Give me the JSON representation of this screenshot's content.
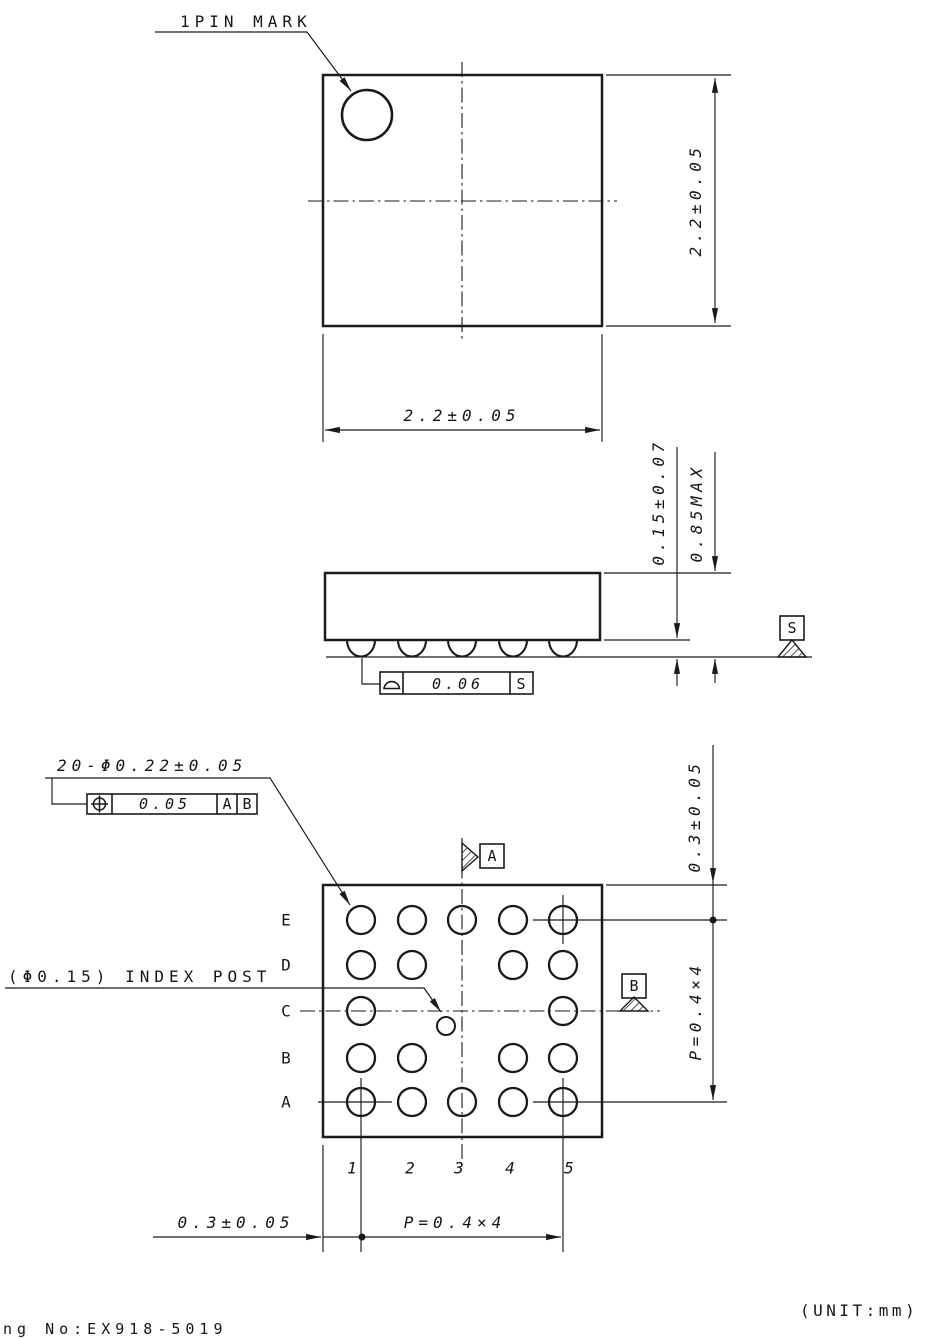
{
  "labels": {
    "pin_mark": "1PIN MARK",
    "index_post": "(Φ0.15) INDEX POST",
    "ball_callout": "20-Φ0.22±0.05",
    "unit": "(UNIT:mm)",
    "drawing_no": "ng No:EX918-5019"
  },
  "dimensions": {
    "body_height": "2.2±0.05",
    "body_width": "2.2±0.05",
    "standoff": "0.15±0.07",
    "max_height": "0.85MAX",
    "edge_to_ball_right": "0.3±0.05",
    "pitch_right": "P=0.4×4",
    "edge_to_ball_bottom": "0.3±0.05",
    "pitch_bottom": "P=0.4×4"
  },
  "tolerances": {
    "coplanarity": {
      "symbol": "profile-of-surface",
      "value": "0.06",
      "datum": "S"
    },
    "position": {
      "symbol": "true-position",
      "value": "0.05",
      "datums": [
        "A",
        "B"
      ]
    }
  },
  "datums": {
    "a": "A",
    "b": "B",
    "s": "S"
  },
  "ball_grid": {
    "ball_count": 20,
    "row_labels": [
      "E",
      "D",
      "C",
      "B",
      "A"
    ],
    "col_labels": [
      "1",
      "2",
      "3",
      "4",
      "5"
    ],
    "present": [
      [
        1,
        1,
        1,
        1,
        1
      ],
      [
        1,
        1,
        0,
        1,
        1
      ],
      [
        1,
        0,
        0,
        0,
        1
      ],
      [
        1,
        1,
        0,
        1,
        1
      ],
      [
        1,
        1,
        1,
        1,
        1
      ]
    ]
  }
}
